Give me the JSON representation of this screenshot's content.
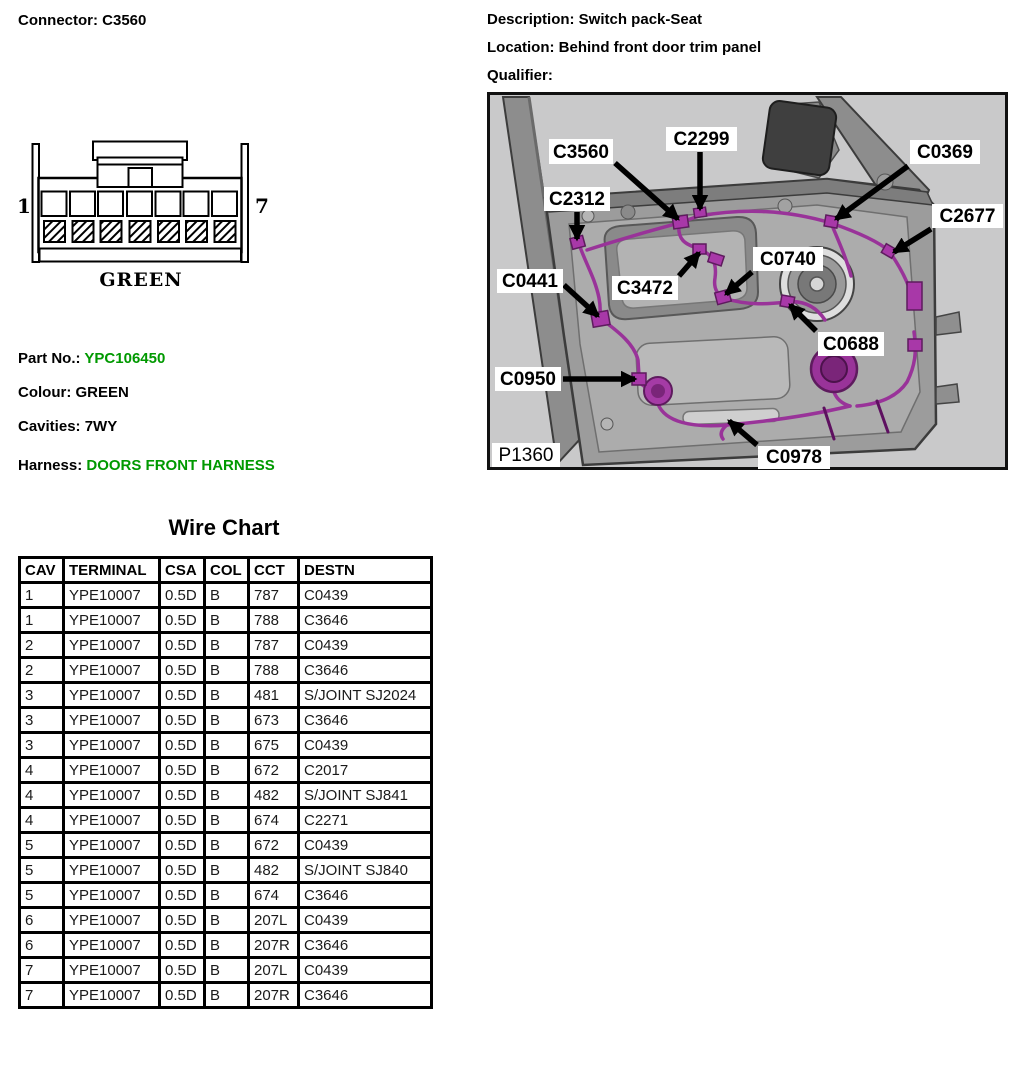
{
  "connector_panel": {
    "heading": "Connector: C3560",
    "pin_first": "1",
    "pin_last": "7",
    "connector_color": "GREEN",
    "part_no": {
      "label": "Part No.:",
      "value": "YPC106450"
    },
    "colour": {
      "label": "Colour:",
      "value": "GREEN"
    },
    "cavities": {
      "label": "Cavities:",
      "value": "7WY"
    },
    "harness": {
      "label": "Harness:",
      "value": "DOORS FRONT HARNESS"
    },
    "green_text_color": "#009900"
  },
  "location_panel": {
    "description": "Description: Switch pack-Seat",
    "location": "Location: Behind front door trim panel",
    "qualifier": "Qualifier:",
    "figure": {
      "figure_id": "P1360",
      "figure_id_box": {
        "x": 5,
        "y": 351,
        "w": 68,
        "h": 24
      },
      "background_color": "#c9c9ca",
      "harness_color": "#993399",
      "callouts": [
        {
          "label": "C3560",
          "box": {
            "x": 62,
            "y": 47,
            "w": 64,
            "h": 25
          },
          "arrow": {
            "x1": 128,
            "y1": 71,
            "x2": 191,
            "y2": 127
          }
        },
        {
          "label": "C2299",
          "box": {
            "x": 179,
            "y": 35,
            "w": 71,
            "h": 24
          },
          "arrow": {
            "x1": 213,
            "y1": 60,
            "x2": 213,
            "y2": 117
          }
        },
        {
          "label": "C0369",
          "box": {
            "x": 423,
            "y": 48,
            "w": 70,
            "h": 24
          },
          "arrow": {
            "x1": 421,
            "y1": 74,
            "x2": 349,
            "y2": 127
          }
        },
        {
          "label": "C2312",
          "box": {
            "x": 57,
            "y": 95,
            "w": 66,
            "h": 24
          },
          "arrow": {
            "x1": 90,
            "y1": 120,
            "x2": 90,
            "y2": 147
          }
        },
        {
          "label": "C2677",
          "box": {
            "x": 445,
            "y": 112,
            "w": 71,
            "h": 24
          },
          "arrow": {
            "x1": 444,
            "y1": 137,
            "x2": 407,
            "y2": 160
          }
        },
        {
          "label": "C0441",
          "box": {
            "x": 10,
            "y": 177,
            "w": 66,
            "h": 24
          },
          "arrow": {
            "x1": 77,
            "y1": 193,
            "x2": 111,
            "y2": 224
          }
        },
        {
          "label": "C3472",
          "box": {
            "x": 125,
            "y": 184,
            "w": 66,
            "h": 24
          },
          "arrow": {
            "x1": 192,
            "y1": 184,
            "x2": 212,
            "y2": 161
          }
        },
        {
          "label": "C0740",
          "box": {
            "x": 266,
            "y": 155,
            "w": 70,
            "h": 24
          },
          "arrow": {
            "x1": 265,
            "y1": 180,
            "x2": 239,
            "y2": 202
          }
        },
        {
          "label": "C0688",
          "box": {
            "x": 331,
            "y": 240,
            "w": 66,
            "h": 24
          },
          "arrow": {
            "x1": 329,
            "y1": 239,
            "x2": 303,
            "y2": 213
          }
        },
        {
          "label": "C0950",
          "box": {
            "x": 8,
            "y": 275,
            "w": 66,
            "h": 24
          },
          "arrow": {
            "x1": 76,
            "y1": 287,
            "x2": 148,
            "y2": 287
          }
        },
        {
          "label": "C0978",
          "box": {
            "x": 271,
            "y": 354,
            "w": 72,
            "h": 23
          },
          "arrow": {
            "x1": 270,
            "y1": 353,
            "x2": 242,
            "y2": 329
          }
        }
      ]
    }
  },
  "wire_chart": {
    "title": "Wire Chart",
    "columns": [
      "CAV",
      "TERMINAL",
      "CSA",
      "COL",
      "CCT",
      "DESTN"
    ],
    "rows": [
      [
        "1",
        "YPE10007",
        "0.5D",
        "B",
        "787",
        "C0439"
      ],
      [
        "1",
        "YPE10007",
        "0.5D",
        "B",
        "788",
        "C3646"
      ],
      [
        "2",
        "YPE10007",
        "0.5D",
        "B",
        "787",
        "C0439"
      ],
      [
        "2",
        "YPE10007",
        "0.5D",
        "B",
        "788",
        "C3646"
      ],
      [
        "3",
        "YPE10007",
        "0.5D",
        "B",
        "481",
        "S/JOINT SJ2024"
      ],
      [
        "3",
        "YPE10007",
        "0.5D",
        "B",
        "673",
        "C3646"
      ],
      [
        "3",
        "YPE10007",
        "0.5D",
        "B",
        "675",
        "C0439"
      ],
      [
        "4",
        "YPE10007",
        "0.5D",
        "B",
        "672",
        "C2017"
      ],
      [
        "4",
        "YPE10007",
        "0.5D",
        "B",
        "482",
        "S/JOINT SJ841"
      ],
      [
        "4",
        "YPE10007",
        "0.5D",
        "B",
        "674",
        "C2271"
      ],
      [
        "5",
        "YPE10007",
        "0.5D",
        "B",
        "672",
        "C0439"
      ],
      [
        "5",
        "YPE10007",
        "0.5D",
        "B",
        "482",
        "S/JOINT SJ840"
      ],
      [
        "5",
        "YPE10007",
        "0.5D",
        "B",
        "674",
        "C3646"
      ],
      [
        "6",
        "YPE10007",
        "0.5D",
        "B",
        "207L",
        "C0439"
      ],
      [
        "6",
        "YPE10007",
        "0.5D",
        "B",
        "207R",
        "C3646"
      ],
      [
        "7",
        "YPE10007",
        "0.5D",
        "B",
        "207L",
        "C0439"
      ],
      [
        "7",
        "YPE10007",
        "0.5D",
        "B",
        "207R",
        "C3646"
      ]
    ]
  }
}
